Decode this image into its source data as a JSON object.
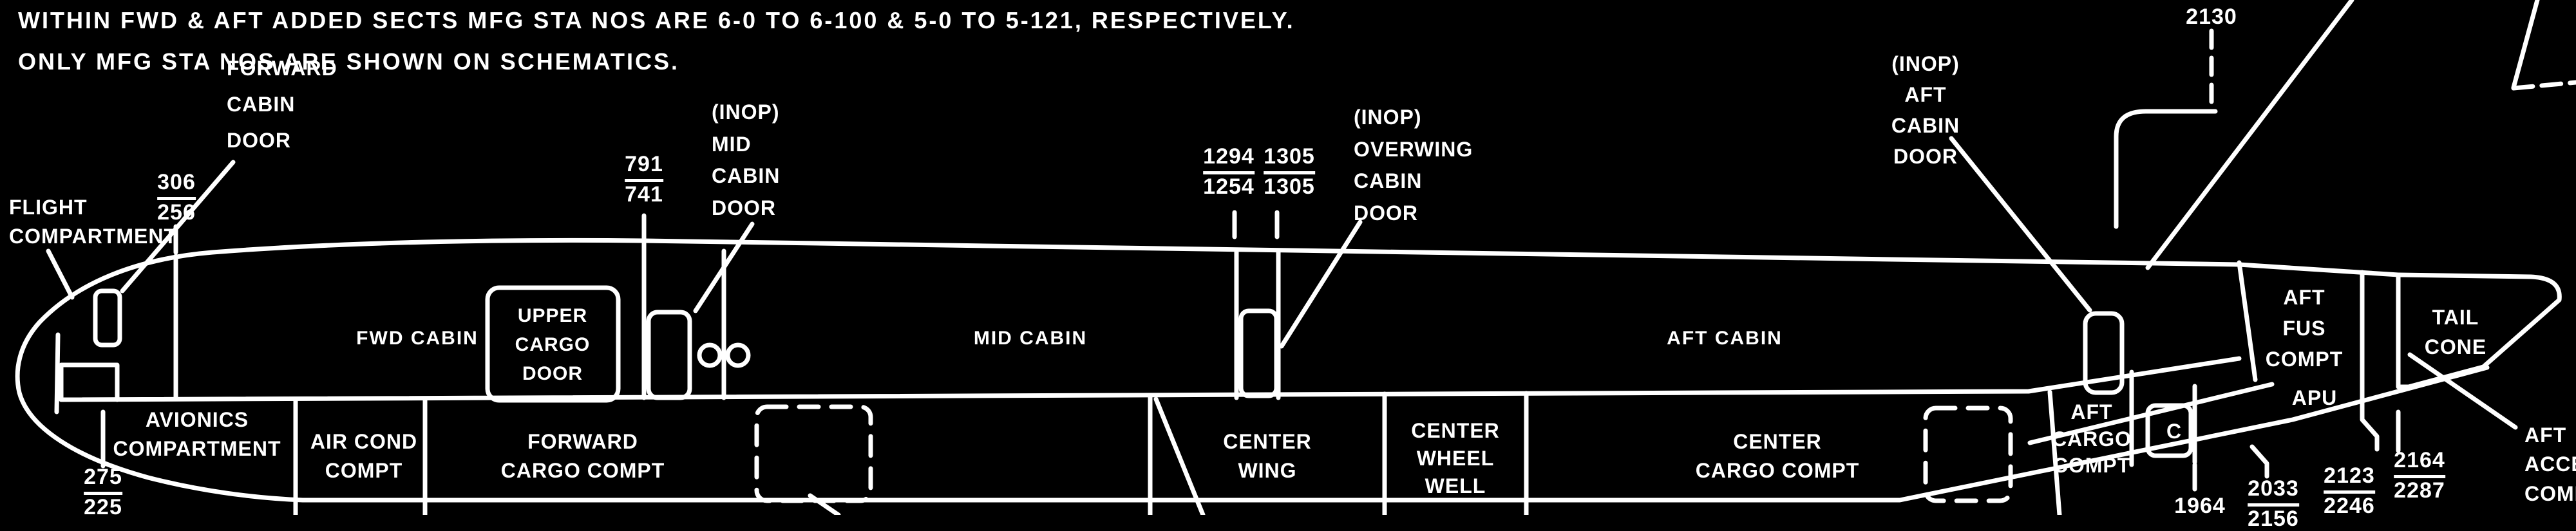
{
  "colors": {
    "background": "#000000",
    "ink": "#ffffff"
  },
  "notes": {
    "line1": "WITHIN FWD & AFT ADDED SECTS MFG STA NOS ARE 6-0 TO 6-100 & 5-0 TO 5-121, RESPECTIVELY.",
    "line2": "ONLY MFG STA NOS ARE SHOWN ON SCHEMATICS."
  },
  "cabin_sections": {
    "fwd": "FWD CABIN",
    "mid": "MID CABIN",
    "aft": "AFT CABIN"
  },
  "callouts": {
    "flight_compartment": {
      "line1": "FLIGHT",
      "line2": "COMPARTMENT"
    },
    "forward_cabin_door": {
      "line1": "FORWARD",
      "line2": "CABIN",
      "line3": "DOOR"
    },
    "mid_cabin_door": {
      "line1": "(INOP)",
      "line2": "MID",
      "line3": "CABIN",
      "line4": "DOOR"
    },
    "overwing_cabin_door": {
      "line1": "(INOP)",
      "line2": "OVERWING",
      "line3": "CABIN",
      "line4": "DOOR"
    },
    "aft_cabin_door": {
      "line1": "(INOP)",
      "line2": "AFT",
      "line3": "CABIN",
      "line4": "DOOR"
    },
    "upper_cargo_door": {
      "line1": "UPPER",
      "line2": "CARGO",
      "line3": "DOOR"
    },
    "aft_fus_compt": {
      "line1": "AFT",
      "line2": "FUS",
      "line3": "COMPT"
    },
    "tail_cone": {
      "line1": "TAIL",
      "line2": "CONE"
    },
    "apu": "APU",
    "cargo_door_c": "C",
    "aft_access_compartment": {
      "line1": "AFT",
      "line2": "ACCESS",
      "line3": "COMPARTMENT"
    }
  },
  "compartments": {
    "avionics": {
      "line1": "AVIONICS",
      "line2": "COMPARTMENT"
    },
    "air_cond": {
      "line1": "AIR COND",
      "line2": "COMPT"
    },
    "forward_cargo": {
      "line1": "FORWARD",
      "line2": "CARGO COMPT"
    },
    "center_wing": {
      "line1": "CENTER",
      "line2": "WING"
    },
    "center_wheel_well": {
      "line1": "CENTER",
      "line2": "WHEEL",
      "line3": "WELL"
    },
    "center_cargo": {
      "line1": "CENTER",
      "line2": "CARGO COMPT"
    },
    "aft_cargo": {
      "line1": "AFT",
      "line2": "CARGO",
      "line3": "COMPT"
    }
  },
  "stations": {
    "sta_306": {
      "fus": "306",
      "mfg": "256"
    },
    "sta_791": {
      "fus": "791",
      "mfg": "741"
    },
    "sta_1294": {
      "fus": "1294",
      "mfg": "1254"
    },
    "sta_1305": {
      "fus": "1305",
      "mfg": "1305"
    },
    "sta_2130": {
      "fus": "2130"
    },
    "sta_275": {
      "fus": "275",
      "mfg": "225"
    },
    "sta_1964": {
      "fus": "1964"
    },
    "sta_2033": {
      "fus": "2033",
      "mfg": "2156"
    },
    "sta_2123": {
      "fus": "2123",
      "mfg": "2246"
    },
    "sta_2164": {
      "fus": "2164",
      "mfg": "2287"
    }
  }
}
